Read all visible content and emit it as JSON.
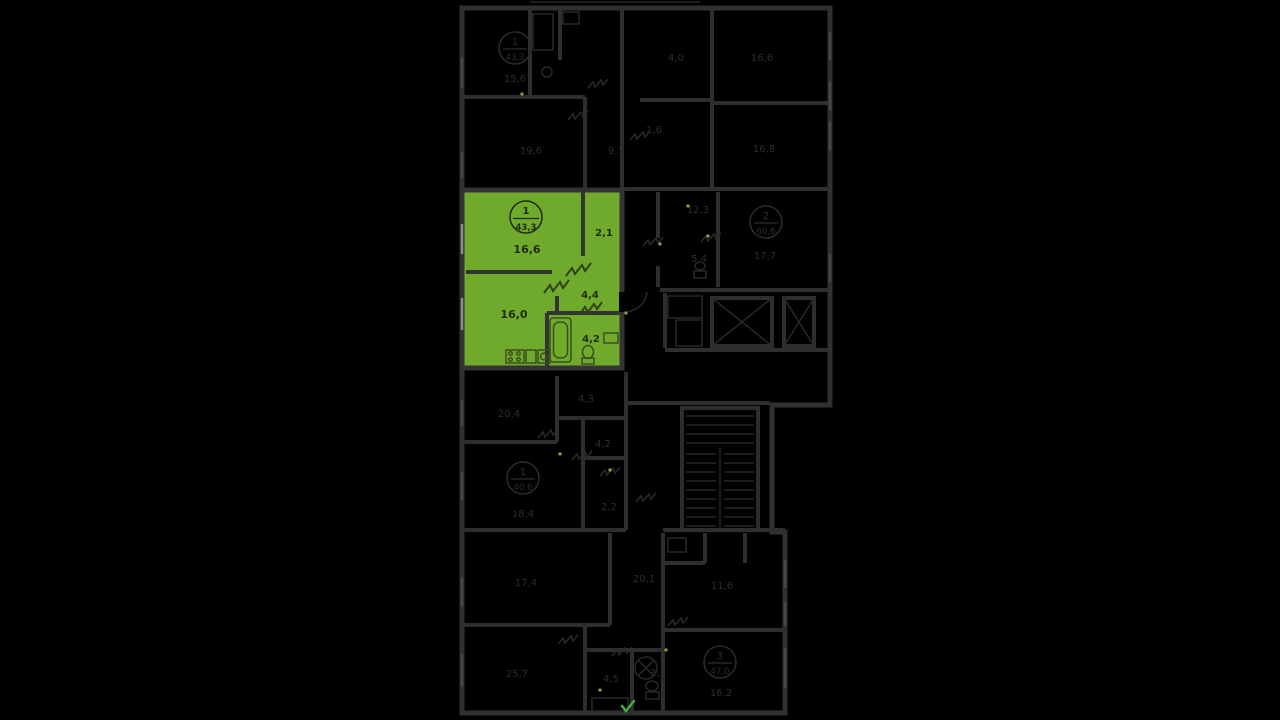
{
  "canvas": {
    "width": 1280,
    "height": 720,
    "background": "#000000"
  },
  "palette": {
    "dim_wall": "#303030",
    "dim_text": "#2d2d2d",
    "apartment_fill": "#6faa2c",
    "apartment_wall": "#333333",
    "apartment_text": "#1e2c0d",
    "hinge_dot": "#9a9a40",
    "entrance_tick": "#3fae3f"
  },
  "selected_apartment": {
    "badge": {
      "number": "1",
      "area": "43,3"
    },
    "rooms": [
      {
        "id": "living-room",
        "area": "16,6"
      },
      {
        "id": "hall",
        "area": "2,1"
      },
      {
        "id": "corridor",
        "area": "4,4"
      },
      {
        "id": "kitchen-living",
        "area": "16,0"
      },
      {
        "id": "bathroom",
        "area": "4,2"
      }
    ]
  },
  "dim_badges": [
    {
      "number": "1",
      "area": "43,3"
    },
    {
      "number": "2",
      "area": "60,6"
    },
    {
      "number": "1",
      "area": "40,6"
    },
    {
      "number": "3",
      "area": "47,0"
    }
  ],
  "dim_labels": [
    {
      "text": "15,6"
    },
    {
      "text": "19,6"
    },
    {
      "text": "9,7"
    },
    {
      "text": "4,0"
    },
    {
      "text": "16,6"
    },
    {
      "text": "1,6"
    },
    {
      "text": "16,8"
    },
    {
      "text": "12,3"
    },
    {
      "text": "17,7"
    },
    {
      "text": "5,4"
    },
    {
      "text": "4,3"
    },
    {
      "text": "20,4"
    },
    {
      "text": "4,2"
    },
    {
      "text": "18,4"
    },
    {
      "text": "2,2"
    },
    {
      "text": "17,4"
    },
    {
      "text": "20,1"
    },
    {
      "text": "25,7"
    },
    {
      "text": "4,5"
    },
    {
      "text": "3,3"
    },
    {
      "text": "11,6"
    },
    {
      "text": "16,2"
    }
  ]
}
